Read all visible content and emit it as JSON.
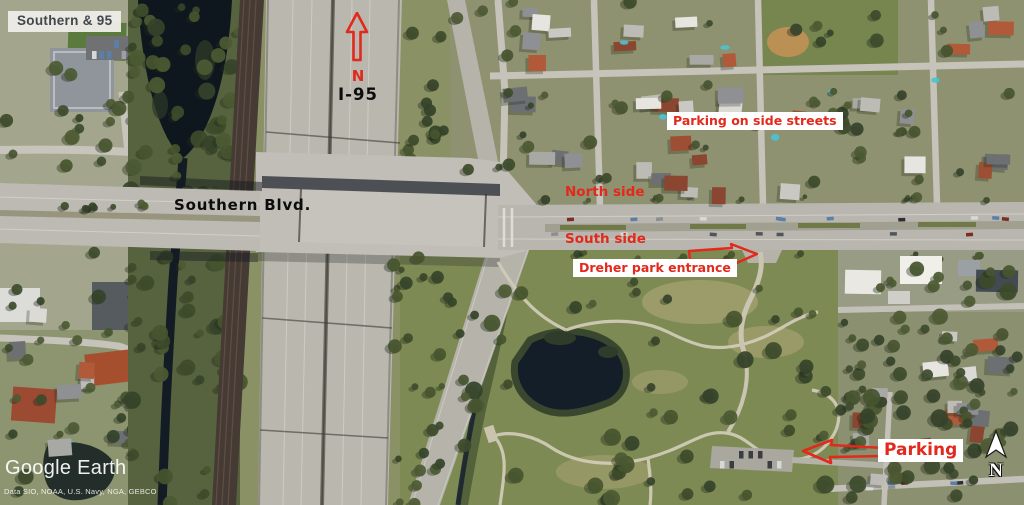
{
  "title_overlay": {
    "label": "Southern & 95"
  },
  "map_labels": {
    "i95": "I-95",
    "southern_blvd": "Southern Blvd."
  },
  "annotations": {
    "north_letter": "N",
    "parking_side_streets": "Parking on side streets",
    "north_side": "North side",
    "south_side": "South side",
    "dreher_entrance": "Dreher park entrance",
    "parking": "Parking"
  },
  "compass": {
    "letter": "N"
  },
  "branding": {
    "logo": "Google Earth",
    "attribution": "Data SIO, NOAA, U.S. Navy, NGA, GEBCO"
  },
  "colors": {
    "annotation_red": "#e2291c",
    "label_bg": "#eeece7",
    "label_text": "#3e434c"
  }
}
